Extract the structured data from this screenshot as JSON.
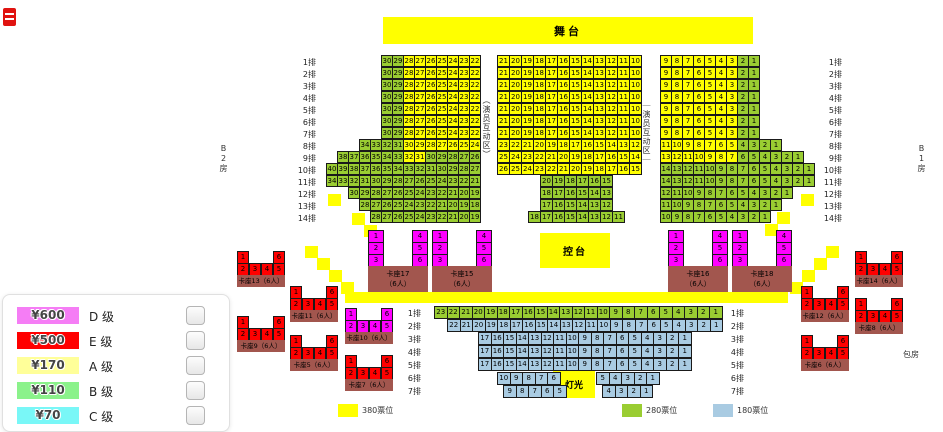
{
  "stage": {
    "label": "舞台"
  },
  "control_desk": {
    "label": "控台"
  },
  "lighting": {
    "label": "灯光"
  },
  "zone_labels": {
    "left": "（演员互动区）",
    "right": "｜演员互动区｜"
  },
  "area_labels": {
    "left_box": "B2房",
    "right_box": "B1房",
    "right_lower_box": "包房"
  },
  "colors": {
    "y": "#FFFF00",
    "g": "#9ACD32",
    "b": "#A9CBE2",
    "m": "#FF00FF",
    "r": "#FF0000",
    "base": "#A2564E"
  },
  "price_legend": {
    "items": [
      {
        "price": "¥600",
        "grade": "D 级",
        "color": "#F57DF5",
        "checked": false
      },
      {
        "price": "¥500",
        "grade": "E 级",
        "color": "#FF0000",
        "checked": false
      },
      {
        "price": "¥170",
        "grade": "A 级",
        "color": "#FFFF99",
        "checked": false
      },
      {
        "price": "¥110",
        "grade": "B 级",
        "color": "#8BF28B",
        "checked": false
      },
      {
        "price": "¥70",
        "grade": "C 级",
        "color": "#79F7F7",
        "checked": false
      }
    ]
  },
  "tier_legend": {
    "items": [
      {
        "label": "380票位",
        "color": "#FFFF00",
        "x": 338
      },
      {
        "label": "280票位",
        "color": "#9ACD32",
        "x": 622
      },
      {
        "label": "180票位",
        "color": "#A9CBE2",
        "x": 713
      }
    ],
    "y": 404
  },
  "seat_blocks": [
    {
      "id": "left",
      "cw": 11,
      "ch": 12,
      "rows": [
        {
          "y": 55,
          "segs": [
            {
              "x": 381,
              "n": "30:22",
              "c": "ggyyyyyyy"
            }
          ]
        },
        {
          "y": 67,
          "segs": [
            {
              "x": 381,
              "n": "30:22",
              "c": "ggyyyyyyy"
            }
          ]
        },
        {
          "y": 79,
          "segs": [
            {
              "x": 381,
              "n": "30:22",
              "c": "ggyyyyyyy"
            }
          ]
        },
        {
          "y": 91,
          "segs": [
            {
              "x": 381,
              "n": "30:22",
              "c": "ggyyyyyyy"
            }
          ]
        },
        {
          "y": 103,
          "segs": [
            {
              "x": 381,
              "n": "30:22",
              "c": "ggyyyyyyy"
            }
          ]
        },
        {
          "y": 115,
          "segs": [
            {
              "x": 381,
              "n": "30:22",
              "c": "ggyyyyyyy"
            }
          ]
        },
        {
          "y": 127,
          "segs": [
            {
              "x": 381,
              "n": "30:22",
              "c": "ggyyyyyyy"
            }
          ]
        },
        {
          "y": 139,
          "segs": [
            {
              "x": 359,
              "n": "34:24",
              "c": "ggggyyyyyyy"
            }
          ]
        },
        {
          "y": 151,
          "segs": [
            {
              "x": 337,
              "n": "38:26",
              "c": "ggggggyyggggg"
            }
          ]
        },
        {
          "y": 163,
          "segs": [
            {
              "x": 326,
              "n": "40:27",
              "c": "g"
            }
          ]
        },
        {
          "y": 175,
          "segs": [
            {
              "x": 326,
              "n": "34:21",
              "c": "g"
            }
          ]
        },
        {
          "y": 187,
          "segs": [
            {
              "x": 348,
              "n": "30:19",
              "c": "g"
            }
          ]
        },
        {
          "y": 199,
          "segs": [
            {
              "x": 359,
              "n": "28:18",
              "c": "g"
            }
          ]
        },
        {
          "y": 211,
          "segs": [
            {
              "x": 370,
              "n": "28:19",
              "c": "g"
            }
          ]
        }
      ]
    },
    {
      "id": "center",
      "cw": 12,
      "ch": 12,
      "rows": [
        {
          "y": 55,
          "segs": [
            {
              "x": 497,
              "n": "21:10",
              "c": "y"
            }
          ]
        },
        {
          "y": 67,
          "segs": [
            {
              "x": 497,
              "n": "21:10",
              "c": "y"
            }
          ]
        },
        {
          "y": 79,
          "segs": [
            {
              "x": 497,
              "n": "21:10",
              "c": "y"
            }
          ]
        },
        {
          "y": 91,
          "segs": [
            {
              "x": 497,
              "n": "21:10",
              "c": "y"
            }
          ]
        },
        {
          "y": 103,
          "segs": [
            {
              "x": 497,
              "n": "21:10",
              "c": "y"
            }
          ]
        },
        {
          "y": 115,
          "segs": [
            {
              "x": 497,
              "n": "21:10",
              "c": "y"
            }
          ]
        },
        {
          "y": 127,
          "segs": [
            {
              "x": 497,
              "n": "21:10",
              "c": "y"
            }
          ]
        },
        {
          "y": 139,
          "segs": [
            {
              "x": 497,
              "n": "23:12",
              "c": "y"
            }
          ]
        },
        {
          "y": 151,
          "segs": [
            {
              "x": 497,
              "n": "25:14",
              "c": "y"
            }
          ]
        },
        {
          "y": 163,
          "segs": [
            {
              "x": 497,
              "n": "26:15",
              "c": "y"
            }
          ]
        },
        {
          "y": 175,
          "segs": [
            {
              "x": 540,
              "n": "20:15",
              "c": "g"
            }
          ]
        },
        {
          "y": 187,
          "segs": [
            {
              "x": 540,
              "n": "18:13",
              "c": "g"
            }
          ]
        },
        {
          "y": 199,
          "segs": [
            {
              "x": 540,
              "n": "17:12",
              "c": "g"
            }
          ]
        },
        {
          "y": 211,
          "segs": [
            {
              "x": 528,
              "n": "18:11",
              "c": "g"
            }
          ]
        }
      ]
    },
    {
      "id": "right",
      "cw": 11,
      "ch": 12,
      "rows": [
        {
          "y": 55,
          "segs": [
            {
              "x": 660,
              "n": "9:1",
              "c": "yyyyyyygg"
            }
          ]
        },
        {
          "y": 67,
          "segs": [
            {
              "x": 660,
              "n": "9:1",
              "c": "yyyyyyygg"
            }
          ]
        },
        {
          "y": 79,
          "segs": [
            {
              "x": 660,
              "n": "9:1",
              "c": "yyyyyyygg"
            }
          ]
        },
        {
          "y": 91,
          "segs": [
            {
              "x": 660,
              "n": "9:1",
              "c": "yyyyyyygg"
            }
          ]
        },
        {
          "y": 103,
          "segs": [
            {
              "x": 660,
              "n": "9:1",
              "c": "yyyyyyygg"
            }
          ]
        },
        {
          "y": 115,
          "segs": [
            {
              "x": 660,
              "n": "9:1",
              "c": "yyyyyyygg"
            }
          ]
        },
        {
          "y": 127,
          "segs": [
            {
              "x": 660,
              "n": "9:1",
              "c": "yyyyyyygg"
            }
          ]
        },
        {
          "y": 139,
          "segs": [
            {
              "x": 660,
              "n": "11:1",
              "c": "yyyyyyygggg"
            }
          ]
        },
        {
          "y": 151,
          "segs": [
            {
              "x": 660,
              "n": "13:1",
              "c": "yyyyyyygggggg"
            }
          ]
        },
        {
          "y": 163,
          "segs": [
            {
              "x": 660,
              "n": "14:1",
              "c": "g"
            }
          ]
        },
        {
          "y": 175,
          "segs": [
            {
              "x": 660,
              "n": "14:1",
              "c": "g"
            }
          ]
        },
        {
          "y": 187,
          "segs": [
            {
              "x": 660,
              "n": "12:1",
              "c": "g"
            }
          ]
        },
        {
          "y": 199,
          "segs": [
            {
              "x": 660,
              "n": "11:1",
              "c": "g"
            }
          ]
        },
        {
          "y": 211,
          "segs": [
            {
              "x": 660,
              "n": "10:1",
              "c": "g"
            }
          ]
        }
      ]
    },
    {
      "id": "bottom",
      "cw": 12.5,
      "ch": 13,
      "rows": [
        {
          "y": 306,
          "segs": [
            {
              "x": 434,
              "n": "23:1",
              "c": "g"
            }
          ]
        },
        {
          "y": 319,
          "segs": [
            {
              "x": 447,
              "n": "22:1",
              "c": "b"
            }
          ]
        },
        {
          "y": 332,
          "segs": [
            {
              "x": 478,
              "n": "17:1",
              "c": "b"
            }
          ]
        },
        {
          "y": 345,
          "segs": [
            {
              "x": 478,
              "n": "17:1",
              "c": "b"
            }
          ]
        },
        {
          "y": 358,
          "segs": [
            {
              "x": 478,
              "n": "17:1",
              "c": "b"
            }
          ]
        },
        {
          "y": 372,
          "segs": [
            {
              "x": 497,
              "n": "10:6",
              "c": "b"
            },
            {
              "x": 596,
              "n": "5:1",
              "c": "b"
            }
          ]
        },
        {
          "y": 385,
          "segs": [
            {
              "x": 503,
              "n": "9:5",
              "c": "b"
            },
            {
              "x": 602,
              "n": "4:1",
              "c": "b"
            }
          ]
        }
      ]
    }
  ],
  "row_label_columns": [
    {
      "x": 294,
      "y": 55,
      "dy": 12,
      "labels": [
        "1排",
        "2排",
        "3排",
        "4排",
        "5排",
        "6排",
        "7排",
        "8排",
        "9排",
        "10排",
        "11排",
        "12排",
        "13排",
        "14排"
      ]
    },
    {
      "x": 820,
      "y": 55,
      "dy": 12,
      "labels": [
        "1排",
        "2排",
        "3排",
        "4排",
        "5排",
        "6排",
        "7排",
        "8排",
        "9排",
        "10排",
        "11排",
        "12排",
        "13排",
        "14排"
      ]
    },
    {
      "x": 399,
      "y": 306,
      "dy": 13,
      "labels": [
        "1排",
        "2排",
        "3排",
        "4排",
        "5排",
        "6排",
        "7排"
      ]
    },
    {
      "x": 722,
      "y": 306,
      "dy": 13,
      "labels": [
        "1排",
        "2排",
        "3排",
        "4排",
        "5排",
        "6排",
        "7排"
      ]
    }
  ],
  "stairs": [
    [
      305,
      246
    ],
    [
      317,
      258
    ],
    [
      329,
      270
    ],
    [
      341,
      282
    ],
    [
      826,
      246
    ],
    [
      814,
      258
    ],
    [
      802,
      270
    ],
    [
      790,
      282
    ],
    [
      328,
      194
    ],
    [
      352,
      213
    ],
    [
      364,
      225
    ],
    [
      801,
      194
    ],
    [
      777,
      212
    ],
    [
      765,
      224
    ]
  ],
  "u_booths": {
    "y": 230,
    "seat_w": 16,
    "seat_h": 12,
    "width": 60,
    "base_h": 26,
    "left_seats": [
      1,
      2,
      3
    ],
    "right_seats": [
      4,
      5,
      6
    ],
    "capacity": "（6人）",
    "items": [
      {
        "x": 368,
        "name": "卡座17"
      },
      {
        "x": 432,
        "name": "卡座15"
      },
      {
        "x": 668,
        "name": "卡座16"
      },
      {
        "x": 732,
        "name": "卡座18"
      }
    ]
  },
  "side_booths": {
    "width": 48,
    "seat_w": 12,
    "seat_h": 12,
    "label_h": 12,
    "top_seats": [
      1,
      6
    ],
    "bottom_seats": [
      2,
      3,
      4,
      5
    ],
    "items": [
      {
        "x": 237,
        "y": 251,
        "color": "r",
        "label": "卡座13（6人）"
      },
      {
        "x": 237,
        "y": 316,
        "color": "r",
        "label": "卡座9（6人）"
      },
      {
        "x": 290,
        "y": 286,
        "color": "r",
        "label": "卡座11（6人）"
      },
      {
        "x": 290,
        "y": 335,
        "color": "r",
        "label": "卡座5（6人）"
      },
      {
        "x": 345,
        "y": 308,
        "color": "m",
        "label": "卡座10（6人）"
      },
      {
        "x": 345,
        "y": 355,
        "color": "r",
        "label": "卡座7（6人）"
      },
      {
        "x": 855,
        "y": 251,
        "color": "r",
        "label": "卡座14（6人）"
      },
      {
        "x": 801,
        "y": 286,
        "color": "r",
        "label": "卡座12（6人）"
      },
      {
        "x": 855,
        "y": 298,
        "color": "r",
        "label": "卡座8（6人）"
      },
      {
        "x": 801,
        "y": 335,
        "color": "r",
        "label": "卡座6（6人）"
      }
    ]
  }
}
